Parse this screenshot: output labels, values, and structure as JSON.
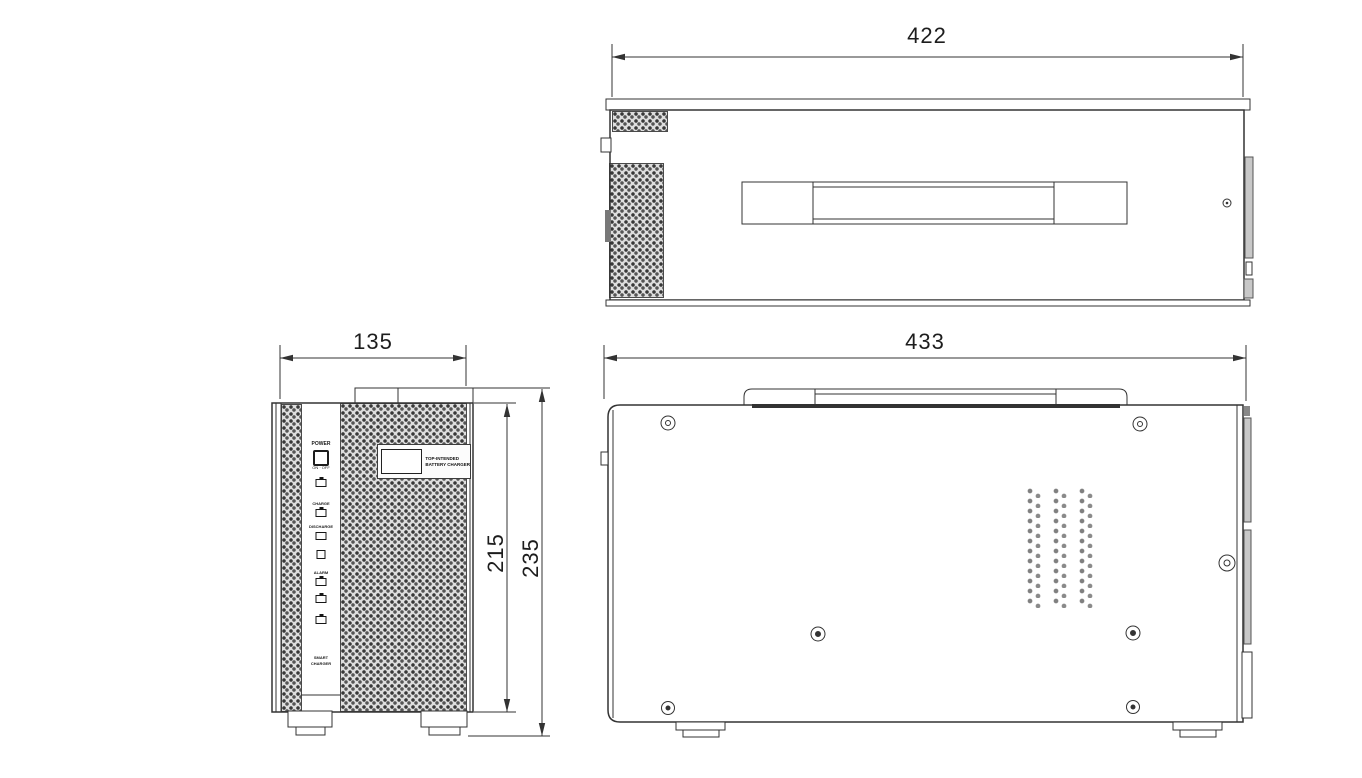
{
  "drawing": {
    "type": "three-view technical drawing",
    "subject": "battery charger enclosure"
  },
  "dimensions": {
    "top_width": "422",
    "front_width": "135",
    "front_body_height": "215",
    "front_total_height": "235",
    "side_width": "433"
  },
  "front_panel": {
    "power_label": "POWER",
    "power_sub": "ON · OFF",
    "charge_label": "CHARGE",
    "discharge_label": "DISCHARGE",
    "alarm_label": "ALARM",
    "footer_line1": "SMART",
    "footer_line2": "CHARGER"
  },
  "nameplate": {
    "line1": "TOP-INTENDED",
    "line2": "BATTERY CHARGER"
  },
  "colors": {
    "line": "#333333",
    "mesh_base": "#dedede",
    "mesh_dot": "#3a3a3a",
    "background": "#ffffff"
  }
}
